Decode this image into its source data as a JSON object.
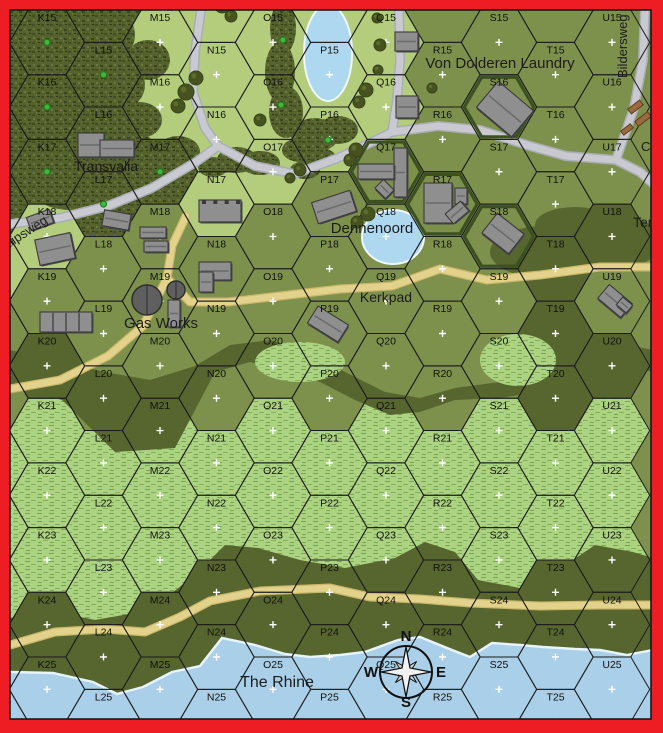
{
  "map": {
    "border_color": "#ee1c23",
    "grid": {
      "columns": "KLMNOPQRSTU",
      "rows_range": [
        15,
        25
      ],
      "origin_x": 47,
      "origin_y": 42.35,
      "col_spacing": 56.5,
      "row_spacing": 64.7,
      "hex_width": 75.4
    },
    "terrain_colors": {
      "light": "#b3cd7d",
      "open": "#7d914d",
      "dark": "#57652f",
      "water": "#a9cfe9",
      "village": "#7d914d",
      "woods_base": "#55622d",
      "brush_base": "#abd381",
      "road_gray": "#c9c9d1",
      "road_tan": "#e3d28c"
    },
    "rows_terrain": {
      "15": "woods,woods,light,light,light,light,light,open,open,open,open",
      "16": "woods,woods,light,light,light,light,light,open,village,open,open",
      "17": "woods,woods,woods,light,light,open,village,village,open,open,open",
      "18": "light,open,open,open,open,open,open,open,village,dark,dark",
      "19": "open,open,open,open,open,open,open,open,open,dark,open",
      "20": "dark,open,open,open,open,open,open,open,open,dark,dark",
      "21": "brush,brush,brush,brush,brush,brush,brush,brush,brush,brush,brush",
      "22": "brush,brush,brush,brush,brush,brush,brush,brush,brush,brush,brush",
      "23": "brush,brush,brush,dark,brush,brush,brush,brush,brush,dark,brush",
      "24": "dark,dark,dark,dark,dark,dark,dark,dark,dark,dark,dark",
      "25": "water,water,water,water,water,water,water,water,water,water,water"
    },
    "edge_hexes": {
      "J14": "woods",
      "J15": "woods",
      "J16": "woods",
      "J17": "woods",
      "J18": "light",
      "J19": "open",
      "J20": "open",
      "J21": "brush",
      "J22": "brush",
      "J23": "brush",
      "J24": "dark",
      "J25": "water",
      "L14": "woods",
      "N14": "light",
      "P14": "light",
      "R14": "open",
      "T14": "open"
    },
    "village_hexes": [
      "S16",
      "Q17",
      "R17",
      "S18"
    ]
  },
  "places": [
    {
      "text": "Von Dolderen Laundry",
      "x": 500,
      "y": 68,
      "size": 15,
      "rot": 0,
      "anchor": "middle"
    },
    {
      "text": "Transvalia",
      "x": 106,
      "y": 171,
      "size": 14,
      "rot": 0,
      "anchor": "middle"
    },
    {
      "text": "Dennenoord",
      "x": 372,
      "y": 233,
      "size": 15,
      "rot": 0,
      "anchor": "middle"
    },
    {
      "text": "Kerkpad",
      "x": 386,
      "y": 302,
      "size": 14,
      "rot": 0,
      "anchor": "middle"
    },
    {
      "text": "Gas Works",
      "x": 161,
      "y": 328,
      "size": 15,
      "rot": 0,
      "anchor": "middle"
    },
    {
      "text": "The Rhine",
      "x": 277,
      "y": 687,
      "size": 16,
      "rot": 0,
      "anchor": "middle"
    },
    {
      "text": "Bildersweg",
      "x": 627,
      "y": 78,
      "size": 13,
      "rot": -90,
      "anchor": "start"
    },
    {
      "text": "alipsweg",
      "x": 6,
      "y": 250,
      "size": 13,
      "rot": -33,
      "anchor": "start"
    },
    {
      "text": "C",
      "x": 641,
      "y": 151,
      "size": 13,
      "rot": 0,
      "anchor": "start"
    },
    {
      "text": "Ter",
      "x": 633,
      "y": 227,
      "size": 14,
      "rot": 0,
      "anchor": "start"
    }
  ],
  "compass": {
    "x": 406,
    "y": 672,
    "n": "N",
    "e": "E",
    "s": "S",
    "w": "W"
  },
  "roads_gray": [
    [
      [
        201,
        10
      ],
      [
        195,
        52
      ],
      [
        193,
        92
      ],
      [
        205,
        128
      ],
      [
        218,
        146
      ],
      [
        196,
        162
      ],
      [
        152,
        188
      ],
      [
        108,
        206
      ],
      [
        60,
        218
      ],
      [
        10,
        224
      ]
    ],
    [
      [
        218,
        146
      ],
      [
        255,
        166
      ],
      [
        295,
        174
      ],
      [
        338,
        158
      ],
      [
        372,
        142
      ],
      [
        392,
        132
      ]
    ],
    [
      [
        392,
        132
      ],
      [
        438,
        126
      ],
      [
        480,
        130
      ],
      [
        530,
        146
      ],
      [
        566,
        156
      ],
      [
        616,
        160
      ],
      [
        640,
        172
      ],
      [
        660,
        190
      ]
    ],
    [
      [
        645,
        10
      ],
      [
        643,
        60
      ],
      [
        634,
        108
      ],
      [
        616,
        160
      ]
    ],
    [
      [
        399,
        10
      ],
      [
        400,
        60
      ],
      [
        397,
        100
      ],
      [
        392,
        132
      ]
    ]
  ],
  "roads_tan": [
    [
      [
        186,
        216
      ],
      [
        172,
        246
      ],
      [
        167,
        278
      ],
      [
        190,
        302
      ],
      [
        228,
        302
      ],
      [
        280,
        296
      ],
      [
        340,
        289
      ],
      [
        392,
        286
      ],
      [
        440,
        269
      ],
      [
        487,
        280
      ],
      [
        540,
        275
      ],
      [
        600,
        267
      ],
      [
        655,
        267
      ]
    ],
    [
      [
        167,
        278
      ],
      [
        143,
        326
      ],
      [
        108,
        356
      ],
      [
        60,
        380
      ],
      [
        10,
        389
      ]
    ],
    [
      [
        10,
        645
      ],
      [
        55,
        632
      ],
      [
        105,
        629
      ],
      [
        145,
        632
      ],
      [
        180,
        617
      ],
      [
        210,
        601
      ],
      [
        260,
        591
      ],
      [
        330,
        588
      ],
      [
        370,
        597
      ],
      [
        420,
        599
      ],
      [
        470,
        603
      ],
      [
        540,
        606
      ],
      [
        600,
        605
      ],
      [
        655,
        605
      ]
    ]
  ],
  "patches": {
    "midband_top": [
      [
        10,
        350
      ],
      [
        55,
        360
      ],
      [
        105,
        372
      ],
      [
        150,
        380
      ],
      [
        195,
        366
      ],
      [
        230,
        345
      ],
      [
        270,
        340
      ],
      [
        310,
        352
      ],
      [
        345,
        372
      ],
      [
        385,
        392
      ],
      [
        420,
        398
      ],
      [
        455,
        388
      ],
      [
        500,
        382
      ],
      [
        540,
        372
      ],
      [
        565,
        345
      ],
      [
        605,
        340
      ],
      [
        653,
        350
      ]
    ],
    "midband_bottom": [
      [
        653,
        372
      ],
      [
        605,
        360
      ],
      [
        565,
        368
      ],
      [
        540,
        392
      ],
      [
        500,
        398
      ],
      [
        455,
        400
      ],
      [
        420,
        412
      ],
      [
        390,
        415
      ],
      [
        355,
        400
      ],
      [
        320,
        382
      ],
      [
        285,
        370
      ],
      [
        250,
        362
      ],
      [
        215,
        372
      ],
      [
        175,
        448
      ],
      [
        115,
        452
      ],
      [
        62,
        400
      ],
      [
        28,
        390
      ],
      [
        10,
        384
      ]
    ],
    "riverbank_top": [
      [
        10,
        618
      ],
      [
        48,
        610
      ],
      [
        95,
        620
      ],
      [
        140,
        612
      ],
      [
        168,
        596
      ],
      [
        195,
        575
      ],
      [
        225,
        545
      ],
      [
        258,
        548
      ],
      [
        300,
        560
      ],
      [
        345,
        568
      ],
      [
        395,
        558
      ],
      [
        425,
        542
      ],
      [
        455,
        552
      ],
      [
        478,
        580
      ],
      [
        520,
        588
      ],
      [
        558,
        570
      ],
      [
        595,
        545
      ],
      [
        633,
        552
      ],
      [
        653,
        558
      ]
    ],
    "shoreline": [
      [
        10,
        672
      ],
      [
        53,
        673
      ],
      [
        93,
        682
      ],
      [
        117,
        694
      ],
      [
        143,
        687
      ],
      [
        172,
        672
      ],
      [
        200,
        666
      ],
      [
        222,
        638
      ],
      [
        255,
        645
      ],
      [
        285,
        654
      ],
      [
        310,
        657
      ],
      [
        340,
        655
      ],
      [
        365,
        652
      ],
      [
        398,
        640
      ],
      [
        420,
        637
      ],
      [
        447,
        648
      ],
      [
        470,
        657
      ],
      [
        492,
        643
      ],
      [
        520,
        645
      ],
      [
        543,
        647
      ],
      [
        575,
        649
      ],
      [
        600,
        650
      ],
      [
        627,
        655
      ],
      [
        653,
        650
      ]
    ],
    "dark_blobs": [
      [
        545,
        252,
        55,
        26
      ],
      [
        612,
        242,
        48,
        28
      ],
      [
        575,
        225,
        40,
        18
      ]
    ],
    "brush_patches": [
      [
        518,
        360,
        38,
        26
      ],
      [
        300,
        362,
        45,
        20
      ]
    ]
  },
  "woods_blobs": [
    [
      40,
      40,
      45,
      40
    ],
    [
      95,
      35,
      40,
      32
    ],
    [
      55,
      100,
      50,
      45
    ],
    [
      110,
      85,
      35,
      28
    ],
    [
      30,
      155,
      35,
      35
    ],
    [
      85,
      150,
      38,
      30
    ],
    [
      115,
      180,
      30,
      22
    ],
    [
      70,
      192,
      35,
      18
    ],
    [
      140,
      120,
      22,
      18
    ],
    [
      148,
      60,
      22,
      20
    ],
    [
      155,
      165,
      36,
      26
    ],
    [
      132,
      150,
      24,
      18
    ],
    [
      178,
      152,
      22,
      16
    ],
    [
      160,
      185,
      26,
      14
    ],
    [
      283,
      28,
      13,
      26
    ],
    [
      280,
      72,
      15,
      30
    ],
    [
      286,
      112,
      17,
      26
    ],
    [
      260,
      163,
      20,
      12
    ],
    [
      237,
      160,
      20,
      13
    ],
    [
      213,
      167,
      15,
      10
    ],
    [
      315,
      135,
      24,
      17
    ],
    [
      338,
      130,
      20,
      14
    ],
    [
      300,
      150,
      18,
      12
    ],
    [
      320,
      158,
      16,
      10
    ],
    [
      305,
      170,
      15,
      9
    ]
  ],
  "ponds": [
    {
      "name": "pond-p15",
      "x": 328,
      "y": 53,
      "rx": 24,
      "ry": 48
    },
    {
      "name": "pond-dennenoord",
      "x": 393,
      "y": 237,
      "rx": 31,
      "ry": 27
    }
  ],
  "buildings": [
    [
      "transvalia-a",
      78,
      133,
      26,
      24,
      0,
      ""
    ],
    [
      "transvalia-b",
      100,
      140,
      34,
      17,
      0,
      ""
    ],
    [
      "q15-house",
      395,
      32,
      23,
      19,
      0,
      ""
    ],
    [
      "q16-house",
      396,
      96,
      22,
      22,
      0,
      ""
    ],
    [
      "s16-house",
      482,
      92,
      46,
      34,
      40,
      ""
    ],
    [
      "q17-main",
      394,
      148,
      13,
      49,
      0,
      ""
    ],
    [
      "q17-wing",
      358,
      164,
      36,
      15,
      0,
      ""
    ],
    [
      "q17-shed",
      377,
      183,
      15,
      12,
      45,
      ""
    ],
    [
      "p17-house",
      314,
      196,
      40,
      22,
      -18,
      ""
    ],
    [
      "r17-a",
      424,
      183,
      28,
      40,
      0,
      ""
    ],
    [
      "r17-b",
      455,
      188,
      12,
      16,
      0,
      ""
    ],
    [
      "r17-c",
      447,
      206,
      20,
      13,
      -40,
      ""
    ],
    [
      "n18-castle",
      199,
      200,
      42,
      22,
      0,
      "c"
    ],
    [
      "k18-a",
      28,
      213,
      24,
      14,
      -20,
      ""
    ],
    [
      "k18-b",
      37,
      236,
      36,
      26,
      -12,
      ""
    ],
    [
      "l18-house",
      103,
      212,
      27,
      16,
      10,
      ""
    ],
    [
      "m18-a",
      140,
      227,
      26,
      11,
      0,
      ""
    ],
    [
      "m18-b",
      144,
      241,
      24,
      11,
      0,
      ""
    ],
    [
      "l19-industrial",
      40,
      312,
      52,
      20,
      0,
      "i"
    ],
    [
      "gas-shed",
      168,
      300,
      12,
      27,
      0,
      ""
    ],
    [
      "n19-a",
      199,
      262,
      32,
      18,
      0,
      ""
    ],
    [
      "n19-b",
      199,
      272,
      14,
      20,
      0,
      ""
    ],
    [
      "p19-house",
      310,
      314,
      36,
      20,
      32,
      ""
    ],
    [
      "u19-a",
      600,
      292,
      30,
      18,
      40,
      ""
    ],
    [
      "u19-b",
      618,
      300,
      13,
      10,
      40,
      ""
    ],
    [
      "s18-house",
      486,
      221,
      34,
      25,
      38,
      ""
    ]
  ],
  "gas_tanks": [
    [
      147,
      300,
      15
    ],
    [
      176,
      290,
      9
    ]
  ],
  "debris": [
    [
      628,
      104,
      15,
      6,
      -38
    ],
    [
      635,
      116,
      16,
      6,
      -38
    ],
    [
      621,
      127,
      12,
      5,
      -38
    ]
  ],
  "trees": [
    [
      222,
      6,
      7
    ],
    [
      231,
      16,
      6
    ],
    [
      196,
      78,
      7
    ],
    [
      186,
      92,
      8
    ],
    [
      178,
      106,
      7
    ],
    [
      377,
      18,
      5
    ],
    [
      380,
      45,
      6
    ],
    [
      378,
      70,
      5
    ],
    [
      366,
      90,
      7
    ],
    [
      359,
      102,
      6
    ],
    [
      356,
      150,
      7
    ],
    [
      350,
      160,
      6
    ],
    [
      368,
      214,
      7
    ],
    [
      357,
      222,
      6
    ],
    [
      432,
      88,
      5
    ],
    [
      300,
      170,
      6
    ],
    [
      290,
      178,
      5
    ],
    [
      260,
      120,
      6
    ]
  ],
  "green_dots": [
    [
      283,
      40
    ],
    [
      281,
      105
    ],
    [
      328,
      140
    ]
  ]
}
